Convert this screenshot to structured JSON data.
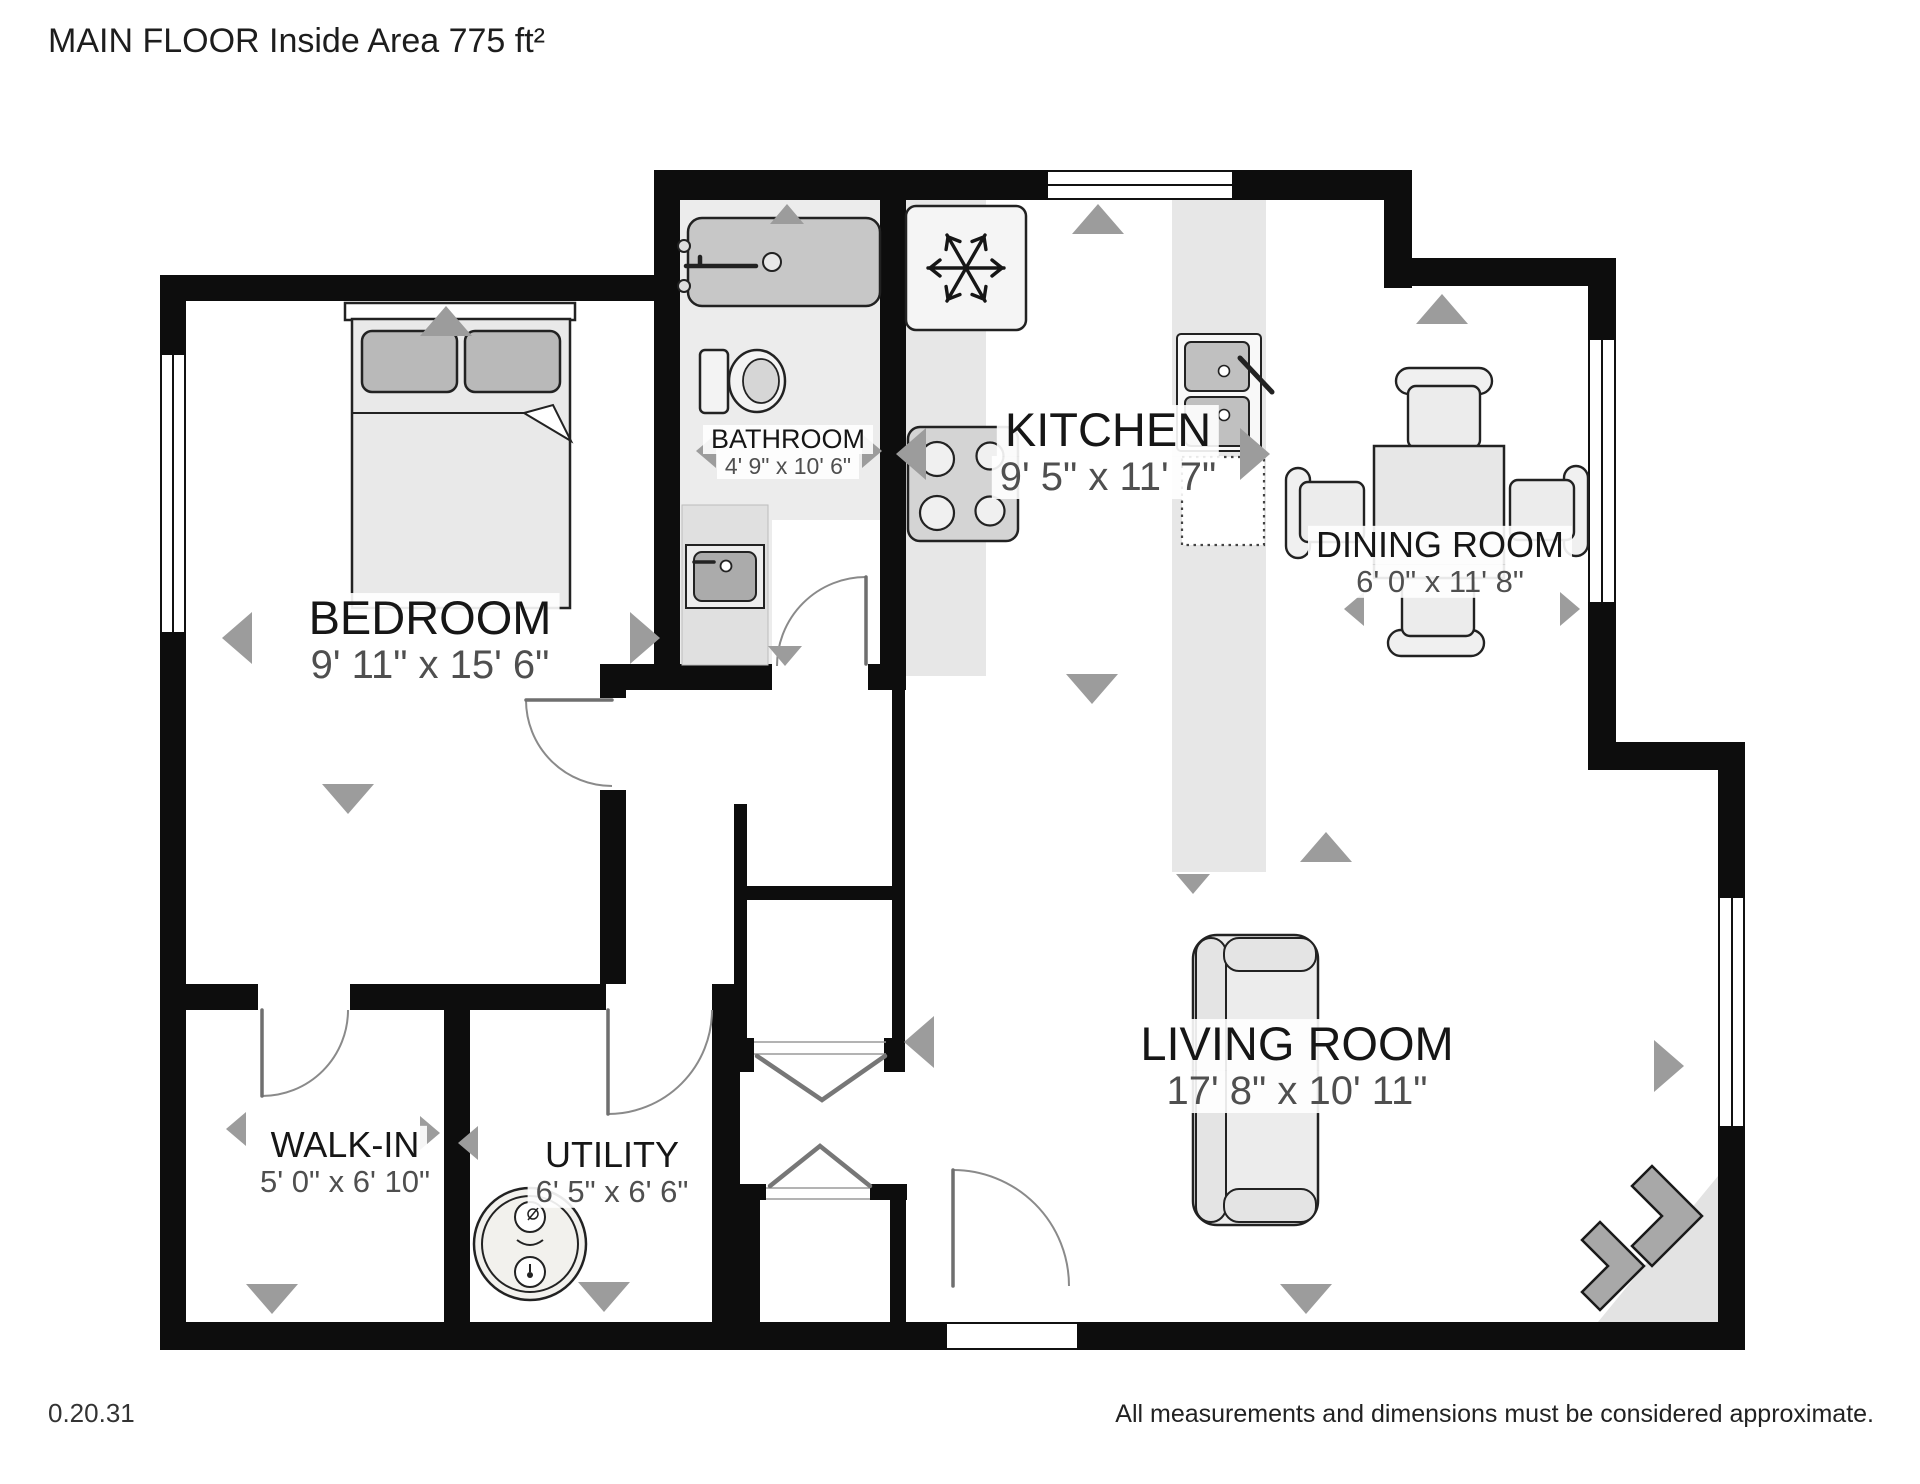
{
  "title": "MAIN FLOOR Inside Area 775 ft²",
  "rooms": {
    "bedroom": {
      "name": "BEDROOM",
      "dims": "9' 11\" x 15' 6\""
    },
    "bathroom": {
      "name": "BATHROOM",
      "dims": "4' 9\" x 10' 6\""
    },
    "kitchen": {
      "name": "KITCHEN",
      "dims": "9' 5\" x 11' 7\""
    },
    "dining": {
      "name": "DINING ROOM",
      "dims": "6' 0\" x 11' 8\""
    },
    "living": {
      "name": "LIVING ROOM",
      "dims": "17' 8\" x 10' 11\""
    },
    "walkin": {
      "name": "WALK-IN",
      "dims": "5' 0\" x 6' 10\""
    },
    "utility": {
      "name": "UTILITY",
      "dims": "6' 5\" x 6' 6\""
    }
  },
  "footer": {
    "version": "0.20.31",
    "disclaimer": "All measurements and dimensions must be considered approximate."
  },
  "colors": {
    "wall": "#0d0d0d",
    "floor_shade": "#ececec",
    "furniture_fill": "#e9e9e9",
    "marker": "#9c9c9c"
  }
}
